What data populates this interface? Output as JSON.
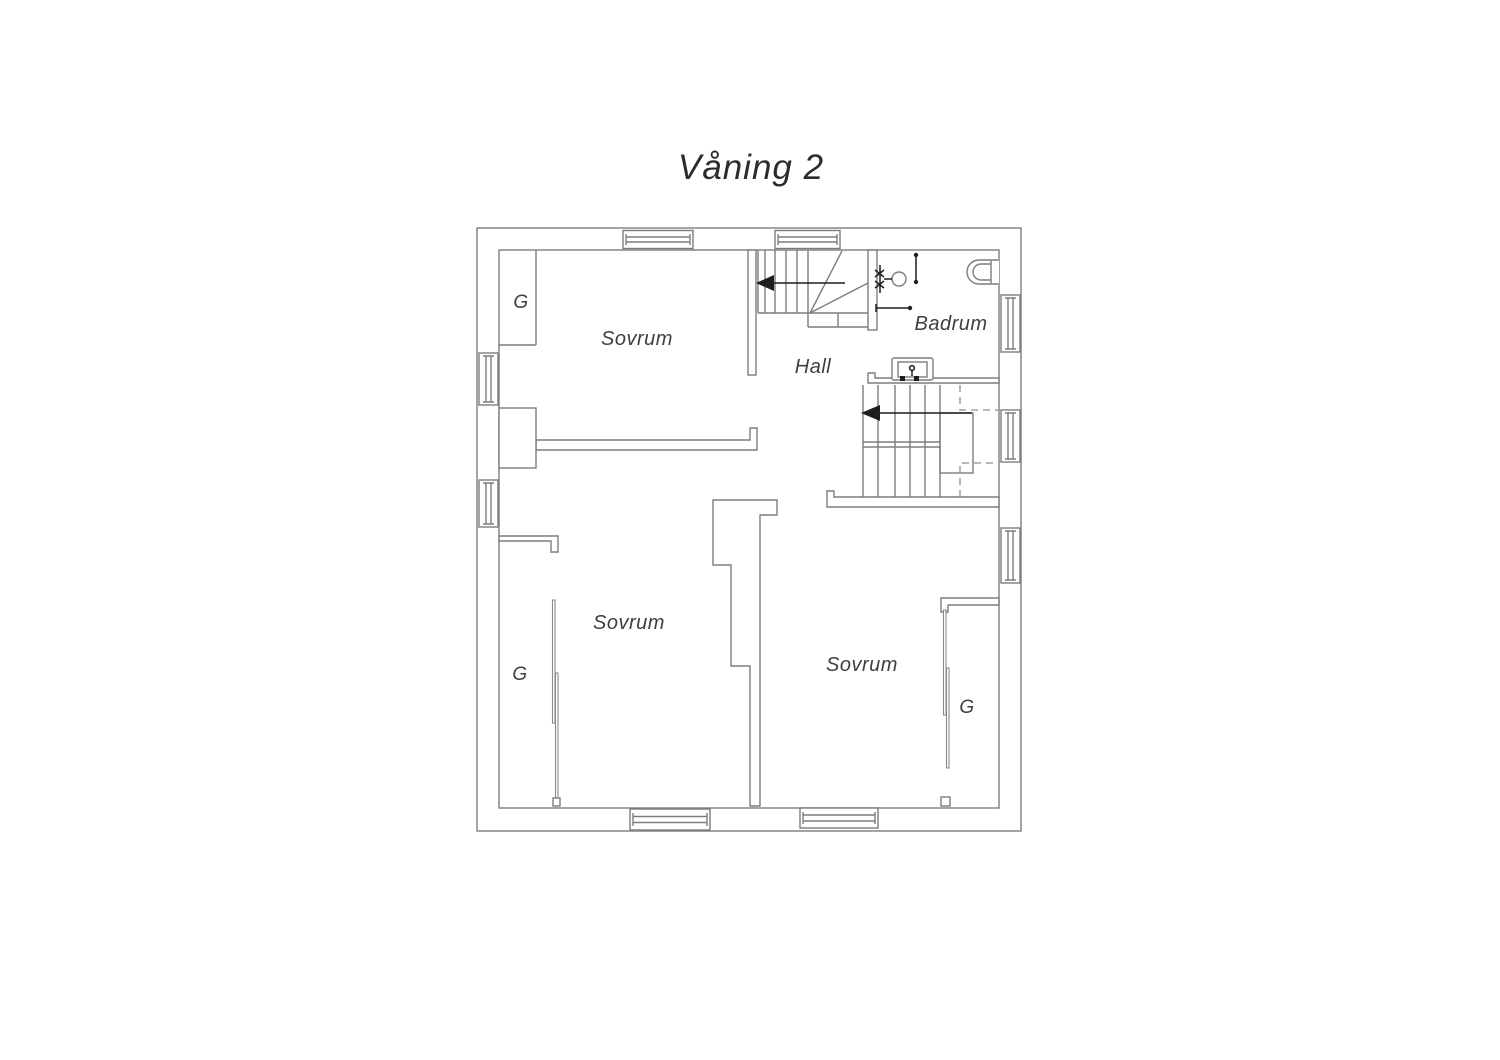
{
  "title": "Våning 2",
  "floor": {
    "bedroom_nw": {
      "label": "Sovrum",
      "closet_label": "G"
    },
    "bedroom_sw": {
      "label": "Sovrum",
      "closet_label": "G"
    },
    "bedroom_se": {
      "label": "Sovrum",
      "closet_label": "G"
    },
    "hall": {
      "label": "Hall"
    },
    "bathroom": {
      "label": "Badrum"
    }
  },
  "colors": {
    "background": "#ffffff",
    "wall_line": "#7d7d7d",
    "text": "#3f3f3f",
    "arrow_black": "#1e1e1e"
  }
}
